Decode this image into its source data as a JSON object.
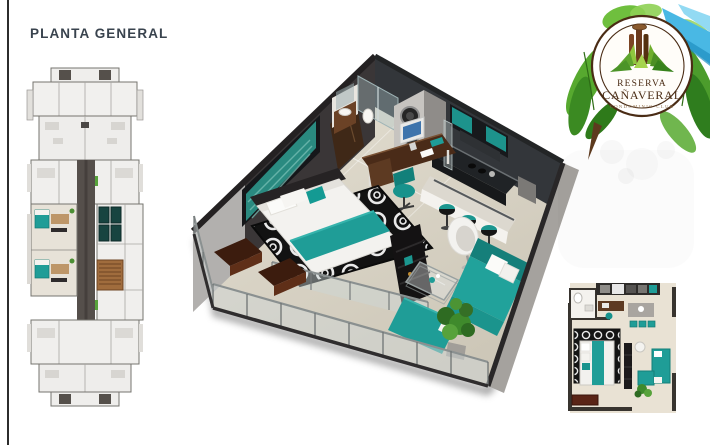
{
  "page": {
    "title": "PLANTA GENERAL"
  },
  "logo": {
    "name_top": "RESERVA",
    "name_bottom": "CAÑAVERAL",
    "tagline": "CONDOMINIO CLUB"
  },
  "figures": {
    "building_plan": "overall-building-floor-plan",
    "apartment_render": "3d-isometric-apartment-render",
    "apartment_plan": "2d-apartment-floor-plan"
  },
  "colors": {
    "accent_teal": "#1f9d97",
    "wall_charcoal": "#323031",
    "floor_beige": "#ddd7c9",
    "wood_brown": "#5d3a1e",
    "leaf_green": "#57a92f",
    "ribbon_blue": "#49b8e4",
    "logo_brown": "#4a2c15",
    "title_text": "#39434e"
  }
}
